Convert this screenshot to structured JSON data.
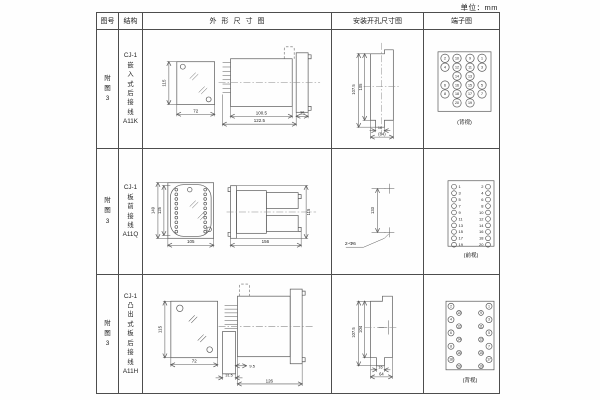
{
  "unit_label": "单位：mm",
  "table": {
    "headers": [
      "图号",
      "结构",
      "外形尺寸图",
      "安装开孔尺寸图",
      "端子图"
    ],
    "rows": [
      {
        "fig_no": "附\n图\n3",
        "structure": "CJ-1\n嵌\n入\n式\n后\n接\n线\nA11K",
        "outline": {
          "front_h": "115",
          "front_w": "72",
          "body_w": "100.5",
          "total_w": "122.5",
          "flange_w": "35"
        },
        "install": {
          "outer_h": "107.5",
          "inner_h": "105",
          "slot_w": "16",
          "total_w": "(64)"
        },
        "terminal": {
          "caption": "(背视)",
          "rows": [
            [
              "2",
              "10",
              "9",
              "1"
            ],
            [
              "4",
              "12",
              "11",
              "3"
            ],
            [
              "14",
              "13"
            ],
            [
              "6",
              "16",
              "15",
              "5"
            ],
            [
              "8",
              "18",
              "17",
              "7"
            ],
            [
              "20",
              "19"
            ]
          ]
        }
      },
      {
        "fig_no": "附\n图\n3",
        "structure": "CJ-1\n板\n前\n接\n线\nA11Q",
        "outline": {
          "front_h": "149",
          "inner_h": "125",
          "front_w": "105",
          "side_w": "156",
          "side_h": "115"
        },
        "install": {
          "height": "133",
          "holes": "2-Φ6"
        },
        "terminal": {
          "caption": "(前视)",
          "left": [
            "1",
            "3",
            "5",
            "7",
            "9",
            "11",
            "13",
            "15",
            "17",
            "19"
          ],
          "right": [
            "2",
            "4",
            "6",
            "8",
            "10",
            "12",
            "14",
            "16",
            "18",
            "20"
          ]
        }
      },
      {
        "fig_no": "附\n图\n3",
        "structure": "CJ-1\n凸\n出\n式\n板\n后\n接\n线\nA11H",
        "outline": {
          "front_h": "115",
          "front_w": "72",
          "shroud_w": "31.5",
          "offset_w": "9.5",
          "total_w": "126"
        },
        "install": {
          "outer_h": "107.5",
          "inner_h": "104",
          "slot_w": "16",
          "total_w": "64"
        },
        "terminal": {
          "caption": "(背视)",
          "left": [
            "2",
            "10",
            "4",
            "12",
            "6",
            "14",
            "8",
            "16",
            "18",
            "20"
          ],
          "right": [
            "1",
            "9",
            "3",
            "11",
            "5",
            "13",
            "7",
            "15",
            "17",
            "19"
          ]
        }
      }
    ]
  }
}
